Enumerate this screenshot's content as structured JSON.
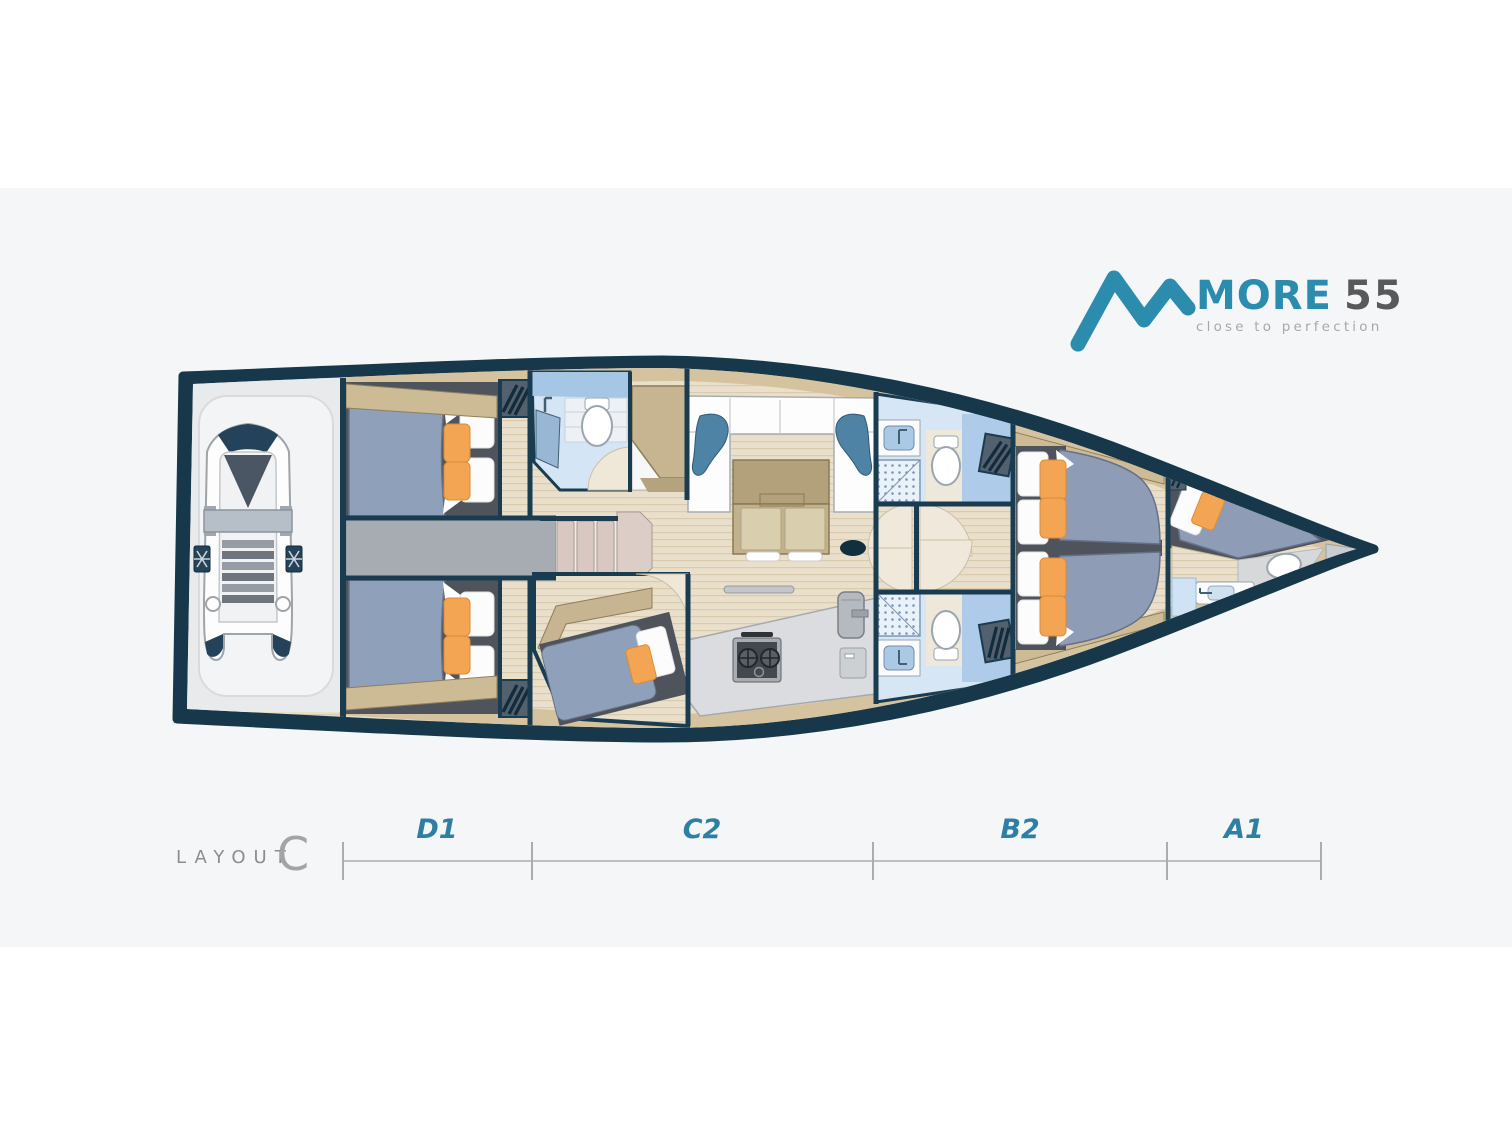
{
  "logo": {
    "icon": "mountain-m-icon",
    "brand": "MORE",
    "model": "55",
    "tagline": "close to perfection"
  },
  "layout_badge": {
    "label": "LAYOUT",
    "variant": "C"
  },
  "sections": [
    {
      "label": "D1"
    },
    {
      "label": "C2"
    },
    {
      "label": "B2"
    },
    {
      "label": "A1"
    }
  ],
  "colors": {
    "accent_teal": "#2b8cad",
    "hull_navy": "#17384a",
    "section_label_teal": "#2e7fa4",
    "background_band": "#f5f6f8",
    "wood_floor": "#eadfca",
    "trim_tan": "#cdbb96",
    "mattress_blue": "#8e9db5",
    "cushion_orange": "#f3a553",
    "bathroom_blue": "#d6e6f5",
    "corridor_gray": "#a7abb2"
  }
}
